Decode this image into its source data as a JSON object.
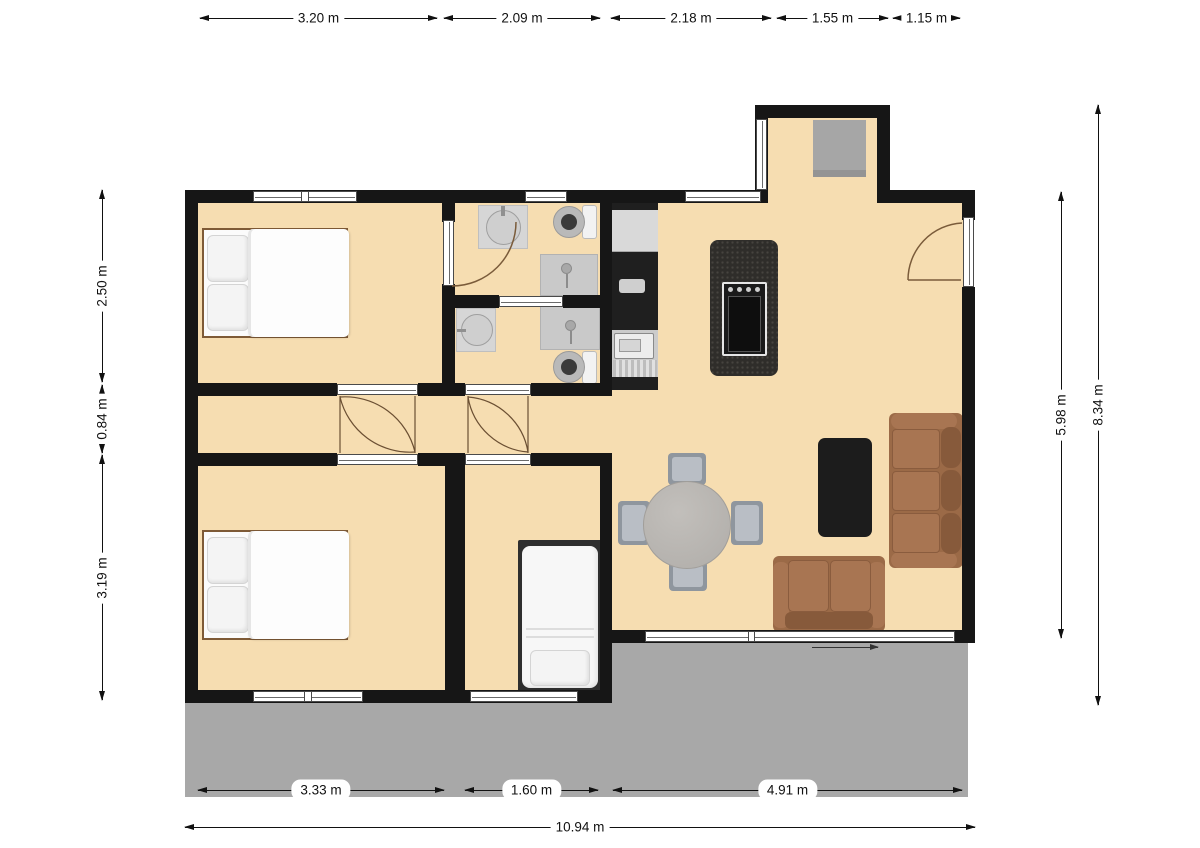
{
  "plan": {
    "title": "apartment-floor-plan",
    "dimensions": {
      "top": [
        {
          "label": "3.20 m"
        },
        {
          "label": "2.09 m"
        },
        {
          "label": "2.18 m"
        },
        {
          "label": "1.55 m"
        },
        {
          "label": "1.15 m"
        }
      ],
      "left": [
        {
          "label": "2.50 m"
        },
        {
          "label": "0.84 m"
        },
        {
          "label": "3.19 m"
        }
      ],
      "right": [
        {
          "label": "5.98 m"
        },
        {
          "label": "8.34 m"
        }
      ],
      "bottom": [
        {
          "label": "3.33 m"
        },
        {
          "label": "1.60 m"
        },
        {
          "label": "4.91 m"
        }
      ],
      "overall_width": {
        "label": "10.94 m"
      }
    },
    "colors": {
      "wall": "#161616",
      "floor": "#f6ddb1",
      "terrace": "#a8a8a8",
      "door_arc": "#7a5b3a",
      "sofa": "#9b6a47",
      "sofa_dark": "#875a3b",
      "sofa_light": "#a87552",
      "island": "#2f2d2a",
      "rug": "#1c1c1c",
      "counter": "#cbcbcb",
      "fixture": "#d6d6d6"
    },
    "rooms": [
      "bedroom-1",
      "bedroom-2",
      "single-bedroom",
      "bathroom-1",
      "bathroom-2",
      "hallway",
      "kitchen",
      "living-dining",
      "entry",
      "terrace"
    ],
    "furniture": [
      "double-bed",
      "double-bed",
      "single-bed",
      "three-seat-sofa",
      "loveseat",
      "round-dining-table",
      "dining-chairs",
      "coffee-table-rug",
      "kitchen-island-stove",
      "kitchen-counter-sink",
      "fridge",
      "bathroom-sink",
      "toilet",
      "shower",
      "entry-mat"
    ]
  }
}
